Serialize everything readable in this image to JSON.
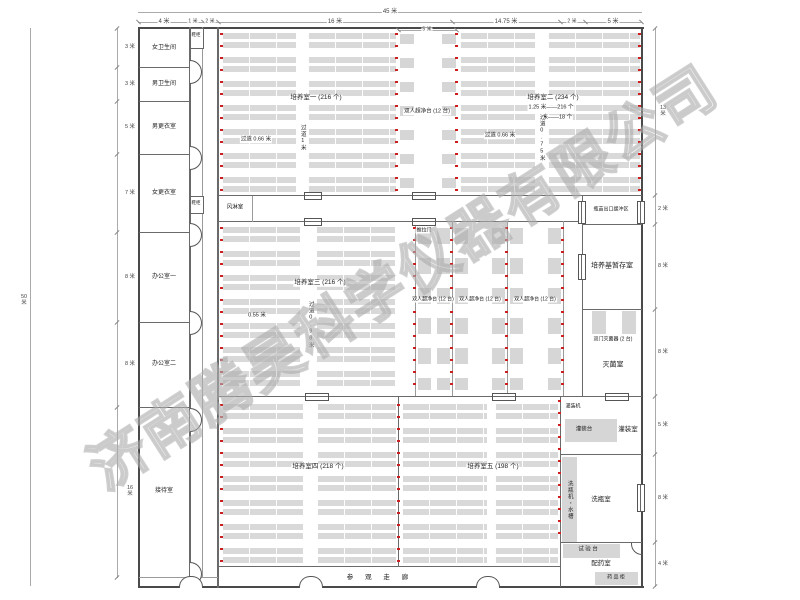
{
  "company_watermark": "济南腾昊科学仪器有限公司",
  "dimensions": {
    "top_total": "45 米",
    "top": [
      "4 米",
      "1 米",
      "2 米",
      "16 米",
      "14.75 米",
      "2 米",
      "5 米"
    ],
    "top_sub": "5 米",
    "left_total": "50 米",
    "left": [
      "3 米",
      "3 米",
      "5 米",
      "7 米",
      "8 米",
      "8 米",
      "16 米"
    ],
    "right": [
      "13 米",
      "2 米",
      "8 米",
      "8 米",
      "5 米",
      "8 米",
      "4 米"
    ]
  },
  "rooms": {
    "left_column": [
      "女卫生间",
      "男卫生间",
      "男更衣室",
      "女更衣室",
      "办公室一",
      "办公室二",
      "接待室"
    ],
    "shoe_cabinet": "鞋柜",
    "air_shower": "风淋室",
    "culture1": "培养室一 (216 个)",
    "culture2": "培养室二 (234 个)",
    "culture2_note1": "1.25 米——216 个",
    "culture2_note2": "1 米——18 个",
    "culture3": "培养室三 (216 个)",
    "culture4": "培养室四 (218 个)",
    "culture5": "培养室五 (198 个)",
    "bench_top": "双人超净台 (12 台)",
    "bench_bay1": "双人超净台 (12 台)",
    "bench_bay2": "双人超净台 (12 台)",
    "bench_bay3": "双人超净台 (12 台)",
    "sliding_door": "推拉门",
    "buffer": "瓶苗出口缓冲区",
    "medium_storage": "培养基暂存室",
    "sterilizer": "双门灭菌器 (2 台)",
    "sterilize_room": "灭菌室",
    "filling_machine": "灌装机",
    "filling_table": "灌装台",
    "filling_room": "灌装室",
    "washer": "洗瓶机・水槽",
    "washing_room": "洗瓶室",
    "test_bench": "试 验 台",
    "dispensing_room": "配药室",
    "medicine_cabinet": "药 品 柜",
    "corridor": "参  观  走  廊"
  },
  "aisles": {
    "a066_1": "过道 0.66 米",
    "a066_2": "过道 0.66 米",
    "a1m": "过道1米",
    "a075": "过道0.75米",
    "a055": "0.55 米",
    "a098": "过道0.98米"
  }
}
